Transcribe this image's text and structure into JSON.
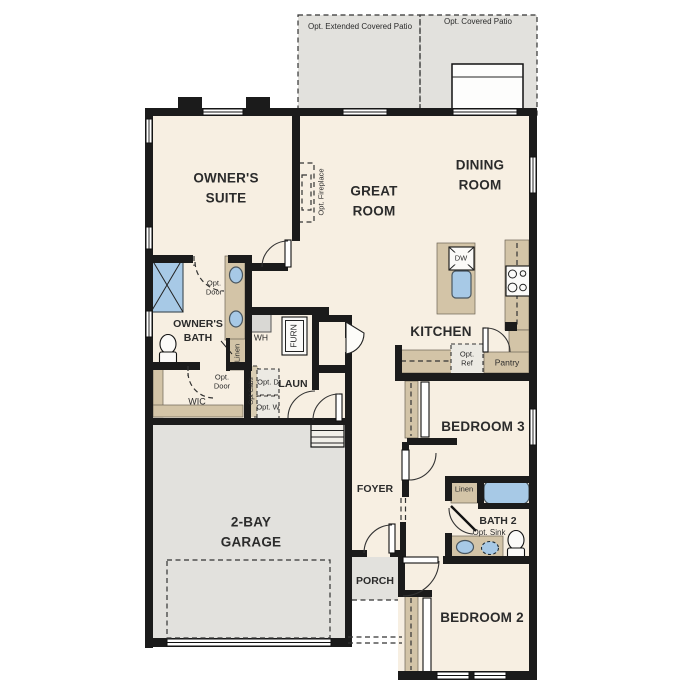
{
  "labels": {
    "patio_extended": "Opt. Extended Covered Patio",
    "patio_covered": "Opt. Covered Patio",
    "owners_suite": "OWNER'S SUITE",
    "great_room": "GREAT ROOM",
    "dining_room": "DINING ROOM",
    "kitchen": "KITCHEN",
    "owners_bath": "OWNER'S BATH",
    "wic": "WIC",
    "laundry": "LAUN",
    "foyer": "FOYER",
    "porch": "PORCH",
    "garage": "2-BAY GARAGE",
    "bedroom3": "BEDROOM 3",
    "bedroom2": "BEDROOM 2",
    "bath2": "BATH 2",
    "opt_sink": "Opt. Sink",
    "pantry": "Pantry",
    "opt_ref": "Opt. Ref",
    "opt_fireplace": "Opt. Fireplace",
    "opt_door_bath": "Opt. Door",
    "opt_door_wic": "Opt. Door",
    "wh": "WH",
    "furn": "FURN",
    "opt_cabs": "Opt Cabs",
    "opt_d": "Opt. D",
    "opt_w": "Opt. W",
    "linen_owners": "Linen",
    "linen_bath2": "Linen",
    "dw": "DW"
  },
  "colors": {
    "floor": "#f7efe2",
    "hard": "#e2e1dd",
    "cabinet": "#d3c4a7",
    "water": "#a7c9e6",
    "wall": "#1b1b1b"
  }
}
